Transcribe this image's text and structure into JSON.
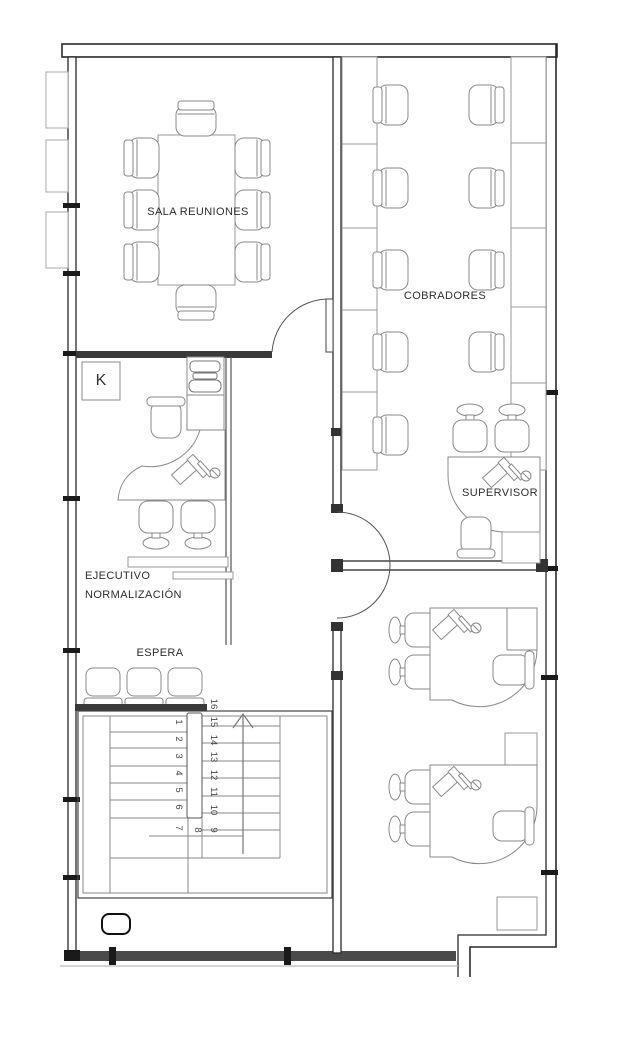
{
  "plan": {
    "rooms": {
      "sala_reuniones": {
        "label": "SALA REUNIONES",
        "chairs": 8,
        "furniture": "conference-table"
      },
      "cobradores": {
        "label": "COBRADORES",
        "chairs_left_row": 5,
        "chairs_right_row": 4
      },
      "supervisor": {
        "label": "SUPERVISOR",
        "visitor_chairs": 2,
        "office_chairs": 1
      },
      "ejecutivo": {
        "label_line1": "EJECUTIVO",
        "label_line2": "NORMALIZACIÓN",
        "visitor_chairs": 2
      },
      "espera": {
        "label": "ESPERA",
        "chairs": 3
      },
      "workstations_bottom_right": {
        "count": 2,
        "visitor_chairs_each": 2
      }
    },
    "marker": {
      "label": "K"
    },
    "stairs": {
      "steps": [
        "1",
        "2",
        "3",
        "4",
        "5",
        "6",
        "7",
        "8",
        "9",
        "10",
        "11",
        "12",
        "13",
        "14",
        "15",
        "16"
      ],
      "direction": "up-arrow"
    },
    "colors": {
      "wall": "#2a2a2a",
      "wall_fill": "#3a3a3a",
      "furniture_line": "#8a8a8a",
      "text": "#2e2e2e",
      "background": "#ffffff"
    }
  }
}
